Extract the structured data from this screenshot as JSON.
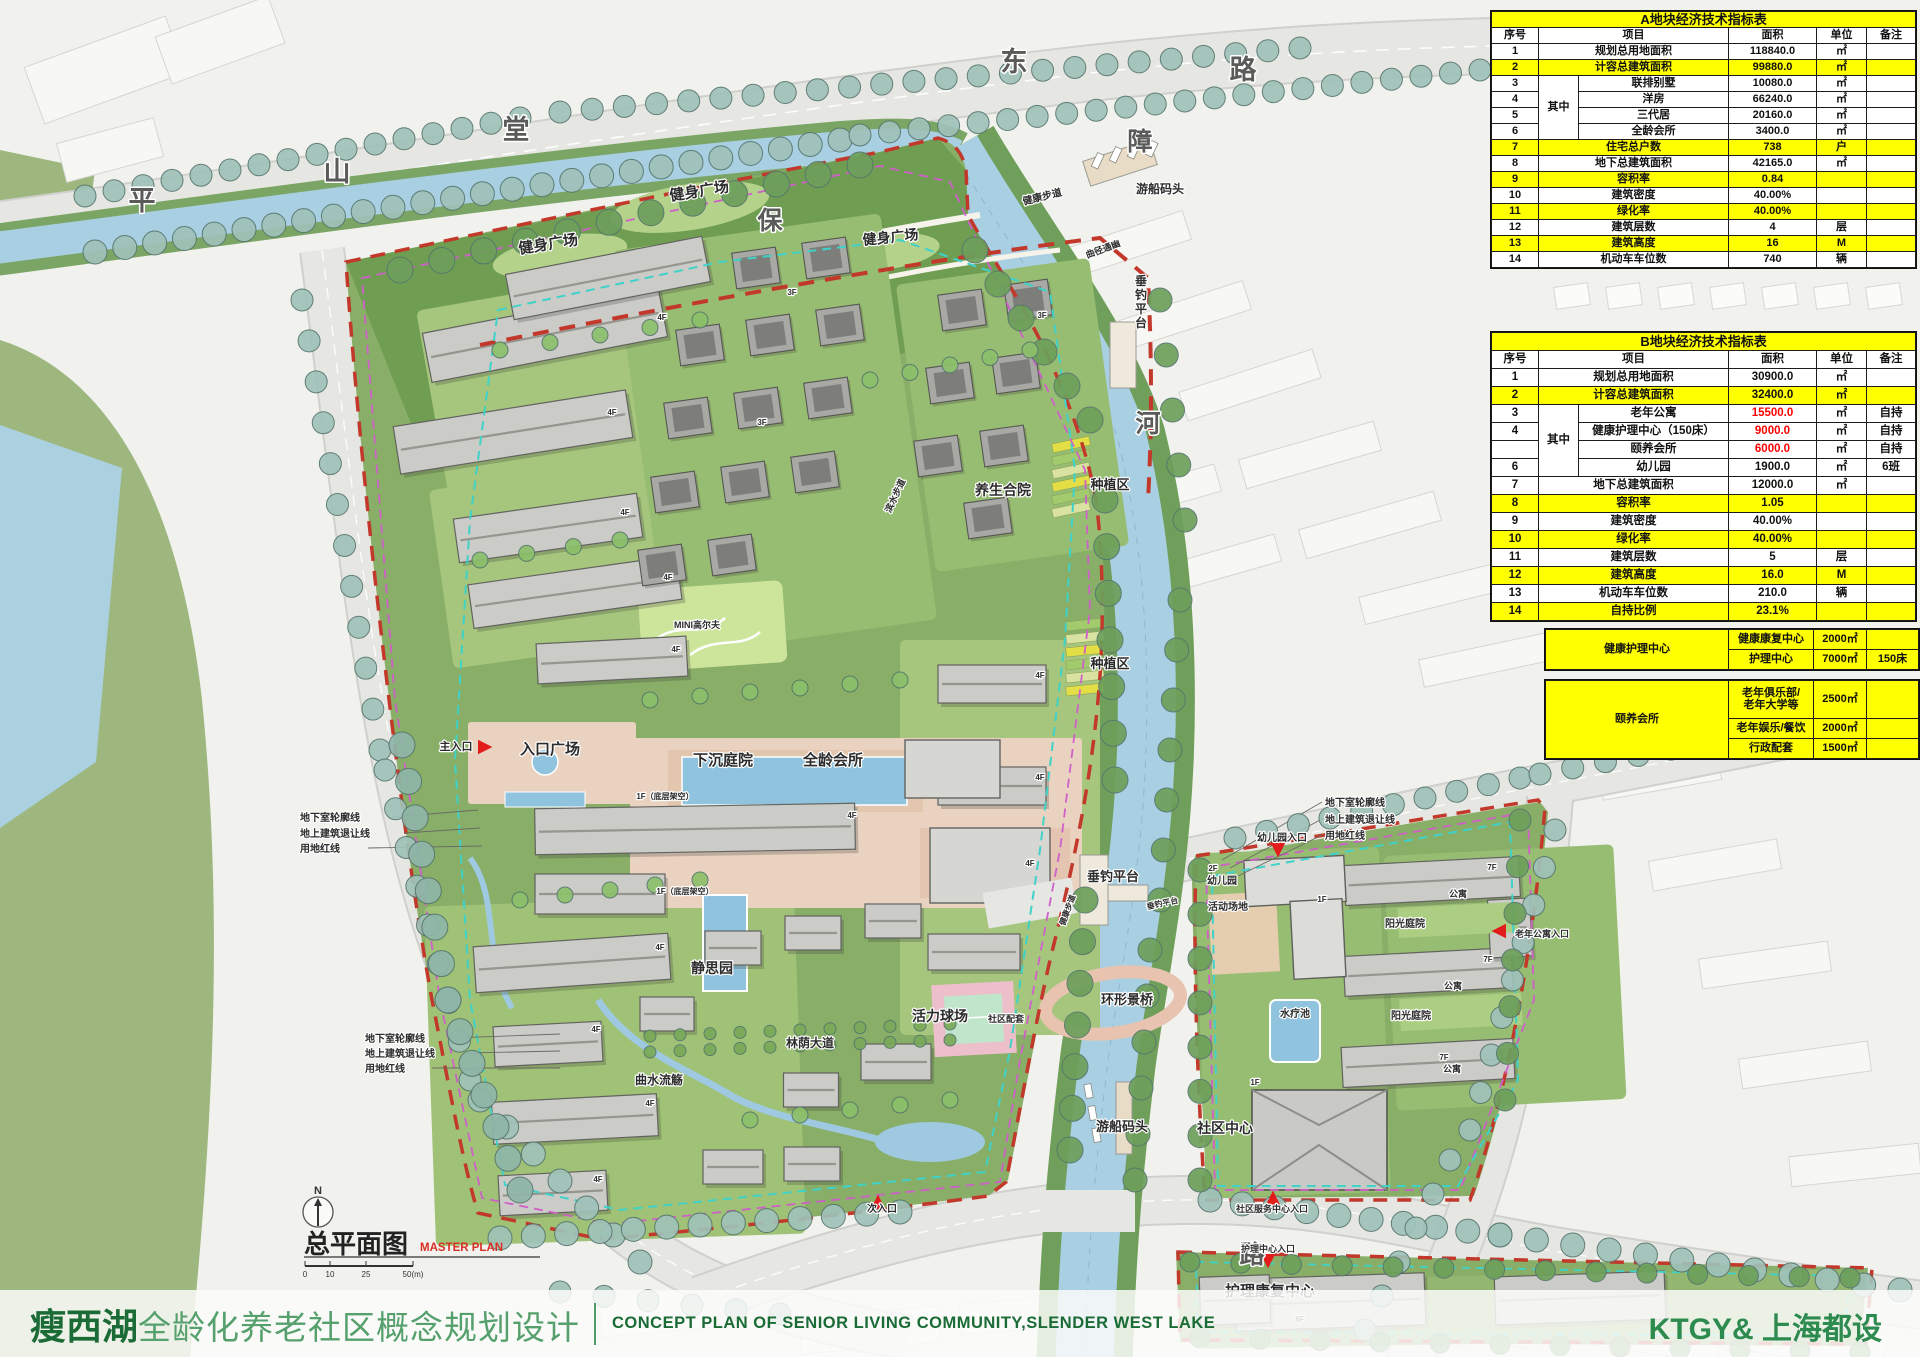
{
  "footer": {
    "title_cn_bold": "瘦西湖",
    "title_cn_rest": "全龄化养老社区概念规划设计",
    "title_en": "CONCEPT PLAN OF SENIOR LIVING COMMUNITY,SLENDER WEST LAKE",
    "firm": "KTGY& 上海都设"
  },
  "titleblock": {
    "plan_title": "总平面图",
    "plan_title_en": "MASTER PLAN",
    "north_label": "N",
    "scale_ticks": [
      "0",
      "10",
      "25",
      "50(m)"
    ]
  },
  "tables": {
    "a": {
      "title": "A地块经济技术指标表",
      "headers": [
        "序号",
        "项目",
        "面积",
        "单位",
        "备注"
      ],
      "group_label": "其中",
      "rows": [
        {
          "no": "1",
          "item": "规划总用地面积",
          "area": "118840.0",
          "unit": "㎡",
          "note": "",
          "hl": false,
          "red": false,
          "grouped": false
        },
        {
          "no": "2",
          "item": "计容总建筑面积",
          "area": "99880.0",
          "unit": "㎡",
          "note": "",
          "hl": true,
          "red": false,
          "grouped": false
        },
        {
          "no": "3",
          "item": "联排别墅",
          "area": "10080.0",
          "unit": "㎡",
          "note": "",
          "hl": false,
          "red": false,
          "grouped": true
        },
        {
          "no": "4",
          "item": "洋房",
          "area": "66240.0",
          "unit": "㎡",
          "note": "",
          "hl": false,
          "red": false,
          "grouped": true
        },
        {
          "no": "5",
          "item": "三代居",
          "area": "20160.0",
          "unit": "㎡",
          "note": "",
          "hl": false,
          "red": false,
          "grouped": true
        },
        {
          "no": "6",
          "item": "全龄会所",
          "area": "3400.0",
          "unit": "㎡",
          "note": "",
          "hl": false,
          "red": false,
          "grouped": true
        },
        {
          "no": "7",
          "item": "住宅总户数",
          "area": "738",
          "unit": "户",
          "note": "",
          "hl": true,
          "red": false,
          "grouped": false
        },
        {
          "no": "8",
          "item": "地下总建筑面积",
          "area": "42165.0",
          "unit": "㎡",
          "note": "",
          "hl": false,
          "red": false,
          "grouped": false
        },
        {
          "no": "9",
          "item": "容积率",
          "area": "0.84",
          "unit": "",
          "note": "",
          "hl": true,
          "red": false,
          "grouped": false
        },
        {
          "no": "10",
          "item": "建筑密度",
          "area": "40.00%",
          "unit": "",
          "note": "",
          "hl": false,
          "red": false,
          "grouped": false
        },
        {
          "no": "11",
          "item": "绿化率",
          "area": "40.00%",
          "unit": "",
          "note": "",
          "hl": true,
          "red": false,
          "grouped": false
        },
        {
          "no": "12",
          "item": "建筑层数",
          "area": "4",
          "unit": "层",
          "note": "",
          "hl": false,
          "red": false,
          "grouped": false
        },
        {
          "no": "13",
          "item": "建筑高度",
          "area": "16",
          "unit": "M",
          "note": "",
          "hl": true,
          "red": false,
          "grouped": false
        },
        {
          "no": "14",
          "item": "机动车车位数",
          "area": "740",
          "unit": "辆",
          "note": "",
          "hl": false,
          "red": false,
          "grouped": false
        }
      ]
    },
    "b": {
      "title": "B地块经济技术指标表",
      "headers": [
        "序号",
        "项目",
        "面积",
        "单位",
        "备注"
      ],
      "group_label": "其中",
      "rows": [
        {
          "no": "1",
          "item": "规划总用地面积",
          "area": "30900.0",
          "unit": "㎡",
          "note": "",
          "hl": false,
          "red": false,
          "grouped": false
        },
        {
          "no": "2",
          "item": "计容总建筑面积",
          "area": "32400.0",
          "unit": "㎡",
          "note": "",
          "hl": true,
          "red": false,
          "grouped": false
        },
        {
          "no": "3",
          "item": "老年公寓",
          "area": "15500.0",
          "unit": "㎡",
          "note": "自持",
          "hl": false,
          "red": true,
          "grouped": true
        },
        {
          "no": "4",
          "item": "健康护理中心（150床）",
          "area": "9000.0",
          "unit": "㎡",
          "note": "自持",
          "hl": false,
          "red": true,
          "grouped": true
        },
        {
          "no": "",
          "item": "颐养会所",
          "area": "6000.0",
          "unit": "㎡",
          "note": "自持",
          "hl": false,
          "red": true,
          "grouped": true
        },
        {
          "no": "6",
          "item": "幼儿园",
          "area": "1900.0",
          "unit": "㎡",
          "note": "6班",
          "hl": false,
          "red": false,
          "grouped": true
        },
        {
          "no": "7",
          "item": "地下总建筑面积",
          "area": "12000.0",
          "unit": "㎡",
          "note": "",
          "hl": false,
          "red": false,
          "grouped": false
        },
        {
          "no": "8",
          "item": "容积率",
          "area": "1.05",
          "unit": "",
          "note": "",
          "hl": true,
          "red": false,
          "grouped": false
        },
        {
          "no": "9",
          "item": "建筑密度",
          "area": "40.00%",
          "unit": "",
          "note": "",
          "hl": false,
          "red": false,
          "grouped": false
        },
        {
          "no": "10",
          "item": "绿化率",
          "area": "40.00%",
          "unit": "",
          "note": "",
          "hl": true,
          "red": false,
          "grouped": false
        },
        {
          "no": "11",
          "item": "建筑层数",
          "area": "5",
          "unit": "层",
          "note": "",
          "hl": false,
          "red": false,
          "grouped": false
        },
        {
          "no": "12",
          "item": "建筑高度",
          "area": "16.0",
          "unit": "M",
          "note": "",
          "hl": true,
          "red": false,
          "grouped": false
        },
        {
          "no": "13",
          "item": "机动车车位数",
          "area": "210.0",
          "unit": "辆",
          "note": "",
          "hl": false,
          "red": false,
          "grouped": false
        },
        {
          "no": "14",
          "item": "自持比例",
          "area": "23.1%",
          "unit": "",
          "note": "",
          "hl": true,
          "red": false,
          "grouped": false
        }
      ]
    },
    "c": {
      "groups": [
        {
          "name": "健康护理中心",
          "rows": [
            {
              "item": "健康康复中心",
              "area": "2000㎡",
              "note": ""
            },
            {
              "item": "护理中心",
              "area": "7000㎡",
              "note": "150床"
            }
          ]
        },
        {
          "name": "颐养会所",
          "rows": [
            {
              "item": "老年俱乐部/\n老年大学等",
              "area": "2500㎡",
              "note": "",
              "tall": true
            },
            {
              "item": "老年娱乐/餐饮",
              "area": "2000㎡",
              "note": ""
            },
            {
              "item": "行政配套",
              "area": "1500㎡",
              "note": ""
            }
          ]
        }
      ]
    }
  },
  "map": {
    "labels": [
      {
        "t": "平",
        "x": 142,
        "y": 210,
        "s": 27,
        "c": "#5a5a58",
        "b": true
      },
      {
        "t": "山",
        "x": 337,
        "y": 181,
        "s": 27,
        "c": "#5a5a58",
        "b": true
      },
      {
        "t": "堂",
        "x": 516,
        "y": 139,
        "s": 27,
        "c": "#5a5a58",
        "b": true
      },
      {
        "t": "东",
        "x": 1014,
        "y": 71,
        "s": 27,
        "c": "#5a5a58",
        "b": true
      },
      {
        "t": "路",
        "x": 1243,
        "y": 79,
        "s": 27,
        "c": "#5a5a58",
        "b": true
      },
      {
        "t": "保",
        "x": 770,
        "y": 229,
        "s": 25,
        "c": "#5a5a58",
        "b": true
      },
      {
        "t": "障",
        "x": 1140,
        "y": 150,
        "s": 25,
        "c": "#5a5a58",
        "b": true
      },
      {
        "t": "河",
        "x": 1148,
        "y": 432,
        "s": 25,
        "c": "#5a5a58",
        "b": true
      },
      {
        "t": "湖",
        "x": 1562,
        "y": 752,
        "s": 25,
        "c": "#5a5a58",
        "b": true
      },
      {
        "t": "路",
        "x": 1252,
        "y": 1263,
        "s": 25,
        "c": "#5a5a58",
        "b": true
      },
      {
        "t": "健身广场",
        "x": 700,
        "y": 196,
        "s": 15,
        "r": -9
      },
      {
        "t": "健身广场",
        "x": 549,
        "y": 249,
        "s": 15,
        "r": -9
      },
      {
        "t": "健身广场",
        "x": 891,
        "y": 242,
        "s": 14,
        "r": -6
      },
      {
        "t": "健康步道",
        "x": 1043,
        "y": 200,
        "s": 10,
        "r": -14
      },
      {
        "t": "游船码头",
        "x": 1160,
        "y": 193,
        "s": 12
      },
      {
        "t": "曲径通幽",
        "x": 1104,
        "y": 252,
        "s": 9,
        "r": -20
      },
      {
        "t": "垂钓平台",
        "x": 1141,
        "y": 285,
        "s": 12,
        "v": true
      },
      {
        "t": "种植区",
        "x": 1110,
        "y": 489,
        "s": 13
      },
      {
        "t": "种植区",
        "x": 1110,
        "y": 668,
        "s": 13
      },
      {
        "t": "养生合院",
        "x": 1003,
        "y": 495,
        "s": 14
      },
      {
        "t": "滨水步道",
        "x": 898,
        "y": 497,
        "s": 9,
        "r": -65
      },
      {
        "t": "MINI高尔夫",
        "x": 697,
        "y": 628,
        "s": 9
      },
      {
        "t": "主入口",
        "x": 456,
        "y": 750,
        "s": 11
      },
      {
        "t": "入口广场",
        "x": 550,
        "y": 754,
        "s": 15
      },
      {
        "t": "下沉庭院",
        "x": 723,
        "y": 765,
        "s": 15
      },
      {
        "t": "全龄会所",
        "x": 833,
        "y": 765,
        "s": 15
      },
      {
        "t": "1F（底层架空）",
        "x": 665,
        "y": 799,
        "s": 8
      },
      {
        "t": "1F（底层架空）",
        "x": 685,
        "y": 894,
        "s": 8
      },
      {
        "t": "静思园",
        "x": 712,
        "y": 973,
        "s": 14
      },
      {
        "t": "曲水流觞",
        "x": 659,
        "y": 1084,
        "s": 12
      },
      {
        "t": "林荫大道",
        "x": 810,
        "y": 1047,
        "s": 12
      },
      {
        "t": "活力球场",
        "x": 940,
        "y": 1021,
        "s": 14
      },
      {
        "t": "社区配套",
        "x": 1006,
        "y": 1022,
        "s": 9
      },
      {
        "t": "环形景桥",
        "x": 1127,
        "y": 1004,
        "s": 13
      },
      {
        "t": "垂钓平台",
        "x": 1113,
        "y": 881,
        "s": 13
      },
      {
        "t": "垂钓平台",
        "x": 1163,
        "y": 906,
        "s": 8,
        "r": -12
      },
      {
        "t": "健康步道",
        "x": 1070,
        "y": 911,
        "s": 8,
        "r": -70
      },
      {
        "t": "游船码头",
        "x": 1122,
        "y": 1131,
        "s": 13
      },
      {
        "t": "社区中心",
        "x": 1225,
        "y": 1133,
        "s": 14
      },
      {
        "t": "次入口",
        "x": 882,
        "y": 1212,
        "s": 10
      },
      {
        "t": "幼儿园入口",
        "x": 1282,
        "y": 841,
        "s": 10
      },
      {
        "t": "2F",
        "x": 1213,
        "y": 871,
        "s": 8
      },
      {
        "t": "幼儿园",
        "x": 1222,
        "y": 884,
        "s": 10
      },
      {
        "t": "活动场地",
        "x": 1228,
        "y": 910,
        "s": 10
      },
      {
        "t": "水疗池",
        "x": 1295,
        "y": 1017,
        "s": 10
      },
      {
        "t": "阳光庭院",
        "x": 1405,
        "y": 927,
        "s": 10
      },
      {
        "t": "阳光庭院",
        "x": 1411,
        "y": 1019,
        "s": 10
      },
      {
        "t": "公寓",
        "x": 1458,
        "y": 897,
        "s": 9
      },
      {
        "t": "公寓",
        "x": 1453,
        "y": 989,
        "s": 9
      },
      {
        "t": "7F",
        "x": 1444,
        "y": 1060,
        "s": 8
      },
      {
        "t": "公寓",
        "x": 1452,
        "y": 1072,
        "s": 9
      },
      {
        "t": "老年公寓入口",
        "x": 1542,
        "y": 937,
        "s": 9
      },
      {
        "t": "社区服务中心入口",
        "x": 1272,
        "y": 1212,
        "s": 9
      },
      {
        "t": "护理中心入口",
        "x": 1268,
        "y": 1252,
        "s": 9
      },
      {
        "t": "护理康复中心",
        "x": 1270,
        "y": 1296,
        "s": 15
      },
      {
        "t": "地下室轮廓线",
        "x": 300,
        "y": 821,
        "s": 10,
        "a": "start"
      },
      {
        "t": "地上建筑退让线",
        "x": 300,
        "y": 837,
        "s": 10,
        "a": "start"
      },
      {
        "t": "用地红线",
        "x": 300,
        "y": 852,
        "s": 10,
        "a": "start"
      },
      {
        "t": "地下室轮廓线",
        "x": 365,
        "y": 1042,
        "s": 10,
        "a": "start"
      },
      {
        "t": "地上建筑退让线",
        "x": 365,
        "y": 1057,
        "s": 10,
        "a": "start"
      },
      {
        "t": "用地红线",
        "x": 365,
        "y": 1072,
        "s": 10,
        "a": "start"
      },
      {
        "t": "地下室轮廓线",
        "x": 1325,
        "y": 806,
        "s": 10,
        "a": "start"
      },
      {
        "t": "地上建筑退让线",
        "x": 1325,
        "y": 823,
        "s": 10,
        "a": "start"
      },
      {
        "t": "用地红线",
        "x": 1325,
        "y": 839,
        "s": 10,
        "a": "start"
      },
      {
        "t": "4F",
        "x": 662,
        "y": 320,
        "s": 8
      },
      {
        "t": "4F",
        "x": 612,
        "y": 415,
        "s": 8
      },
      {
        "t": "4F",
        "x": 625,
        "y": 515,
        "s": 8
      },
      {
        "t": "4F",
        "x": 668,
        "y": 580,
        "s": 8
      },
      {
        "t": "4F",
        "x": 676,
        "y": 652,
        "s": 8
      },
      {
        "t": "4F",
        "x": 852,
        "y": 818,
        "s": 8
      },
      {
        "t": "4F",
        "x": 660,
        "y": 950,
        "s": 8
      },
      {
        "t": "4F",
        "x": 596,
        "y": 1032,
        "s": 8
      },
      {
        "t": "4F",
        "x": 650,
        "y": 1106,
        "s": 8
      },
      {
        "t": "4F",
        "x": 598,
        "y": 1182,
        "s": 8
      },
      {
        "t": "4F",
        "x": 1040,
        "y": 678,
        "s": 8
      },
      {
        "t": "4F",
        "x": 1040,
        "y": 780,
        "s": 8
      },
      {
        "t": "4F",
        "x": 1030,
        "y": 866,
        "s": 8
      },
      {
        "t": "3F",
        "x": 792,
        "y": 295,
        "s": 8
      },
      {
        "t": "3F",
        "x": 762,
        "y": 425,
        "s": 8
      },
      {
        "t": "3F",
        "x": 1042,
        "y": 318,
        "s": 8
      },
      {
        "t": "7F",
        "x": 1492,
        "y": 870,
        "s": 8
      },
      {
        "t": "7F",
        "x": 1488,
        "y": 962,
        "s": 8
      },
      {
        "t": "1F",
        "x": 1322,
        "y": 902,
        "s": 8
      },
      {
        "t": "1F",
        "x": 1255,
        "y": 1085,
        "s": 8
      },
      {
        "t": "6F",
        "x": 1300,
        "y": 1322,
        "s": 8
      }
    ],
    "arrows": [
      {
        "x": 487,
        "y": 747,
        "dir": "right"
      },
      {
        "x": 878,
        "y": 1200,
        "dir": "up"
      },
      {
        "x": 1278,
        "y": 852,
        "dir": "down"
      },
      {
        "x": 1497,
        "y": 931,
        "dir": "left"
      },
      {
        "x": 1273,
        "y": 1196,
        "dir": "up"
      },
      {
        "x": 1268,
        "y": 1263,
        "dir": "down"
      }
    ]
  }
}
